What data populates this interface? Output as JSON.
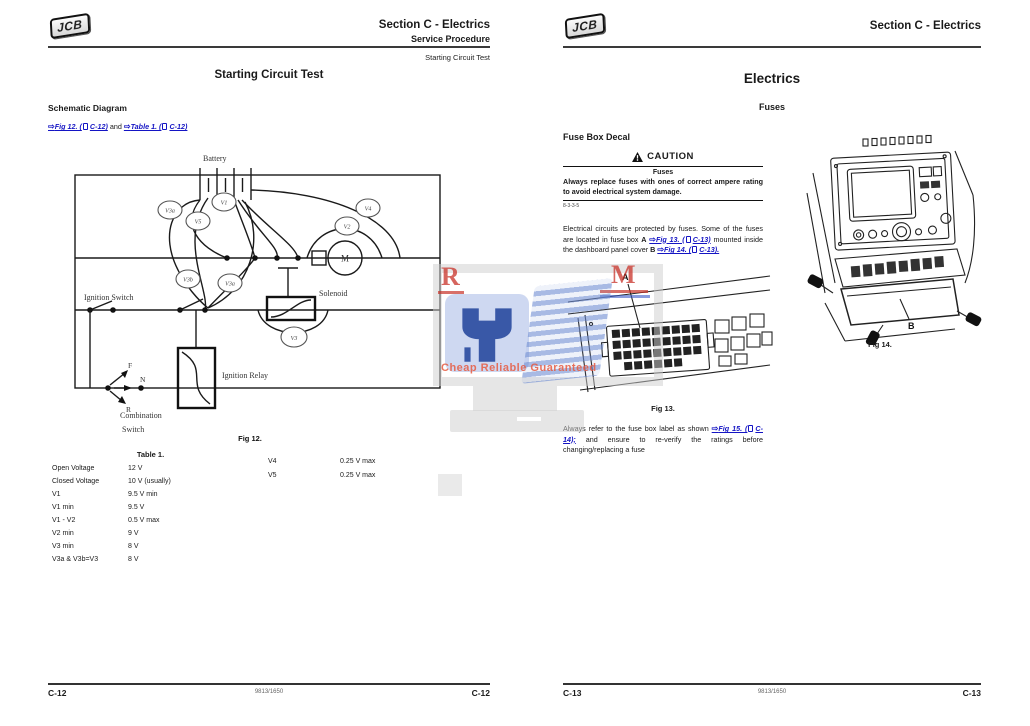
{
  "icons": {
    "xref_arrow": "⇨",
    "caution_triangle": "warning-triangle",
    "page_ref": "page-icon"
  },
  "watermark": {
    "letter_r": "R",
    "letter_m": "M",
    "tagline": "Cheap Reliable Guaranteed"
  },
  "left_page": {
    "logo": "JCB",
    "header": {
      "section": "Section C - Electrics",
      "subsection": "Service Procedure",
      "topic": "Starting Circuit Test"
    },
    "title": "Starting Circuit Test",
    "heading": "Schematic Diagram",
    "refs": {
      "ref1": "Fig 12. (",
      "ref1_page": "C-12)",
      "conj": "and",
      "ref2": "Table 1. (",
      "ref2_page": "C-12)"
    },
    "schematic": {
      "caption": "Fig 12.",
      "battery": "Battery",
      "ignition_switch": "Ignition Switch",
      "solenoid": "Solenoid",
      "ignition_relay": "Ignition Relay",
      "combination_1": "Combination",
      "combination_2": "Switch",
      "motor": "M",
      "f": "F",
      "n": "N",
      "r": "R",
      "v1": "V1",
      "v2": "V2",
      "v3": "V3",
      "v3a": "V3a",
      "v3b": "V3b",
      "v3a2": "V3a",
      "v4": "V4",
      "v5": "V5"
    },
    "table": {
      "caption": "Table 1.",
      "rows": [
        {
          "label": "Open Voltage",
          "value": "12 V"
        },
        {
          "label": "Closed Voltage",
          "value": "10 V (usually)"
        },
        {
          "label": "V1",
          "value": "9.5 V min"
        },
        {
          "label": "V1 min",
          "value": "9.5 V"
        },
        {
          "label": "V1 - V2",
          "value": "0.5 V max"
        },
        {
          "label": "V2 min",
          "value": "9 V"
        },
        {
          "label": "V3 min",
          "value": "8 V"
        },
        {
          "label": "V3a & V3b=V3",
          "value": "8 V"
        }
      ],
      "rows_right": [
        {
          "label": "V4",
          "value": "0.25 V max"
        },
        {
          "label": "V5",
          "value": "0.25 V max"
        }
      ]
    },
    "footer": {
      "left": "C-12",
      "center": "9813/1650",
      "right": "C-12"
    }
  },
  "right_page": {
    "logo": "JCB",
    "header": {
      "section": "Section C - Electrics"
    },
    "title": "Electrics",
    "subtitle": "Fuses",
    "heading": "Fuse Box Decal",
    "caution": {
      "label": "CAUTION",
      "title": "Fuses",
      "body": "Always replace fuses with ones of correct ampere rating to avoid electrical system damage.",
      "code": "8-3-3-5"
    },
    "para1": {
      "t1": "Electrical circuits are protected by fuses. Some of the fuses are located in fuse box",
      "b1": "A",
      "ref1": "Fig 13. (",
      "ref1_page": "C-13)",
      "t2": "mounted inside the dashboard panel cover",
      "b2": "B",
      "ref2": "Fig 14. (",
      "ref2_page": "C-13)."
    },
    "fig13": {
      "caption": "Fig 13.",
      "label": "A"
    },
    "fig14": {
      "caption": "Fig 14.",
      "label": "B"
    },
    "para2": {
      "t1": "Always refer to the fuse box label as shown",
      "ref1": "Fig 15. (",
      "ref1_page": "C-14);",
      "t2": "and ensure to re-verify the ratings before changing/replacing a fuse"
    },
    "footer": {
      "left": "C-13",
      "center": "9813/1650",
      "right": "C-13"
    }
  }
}
